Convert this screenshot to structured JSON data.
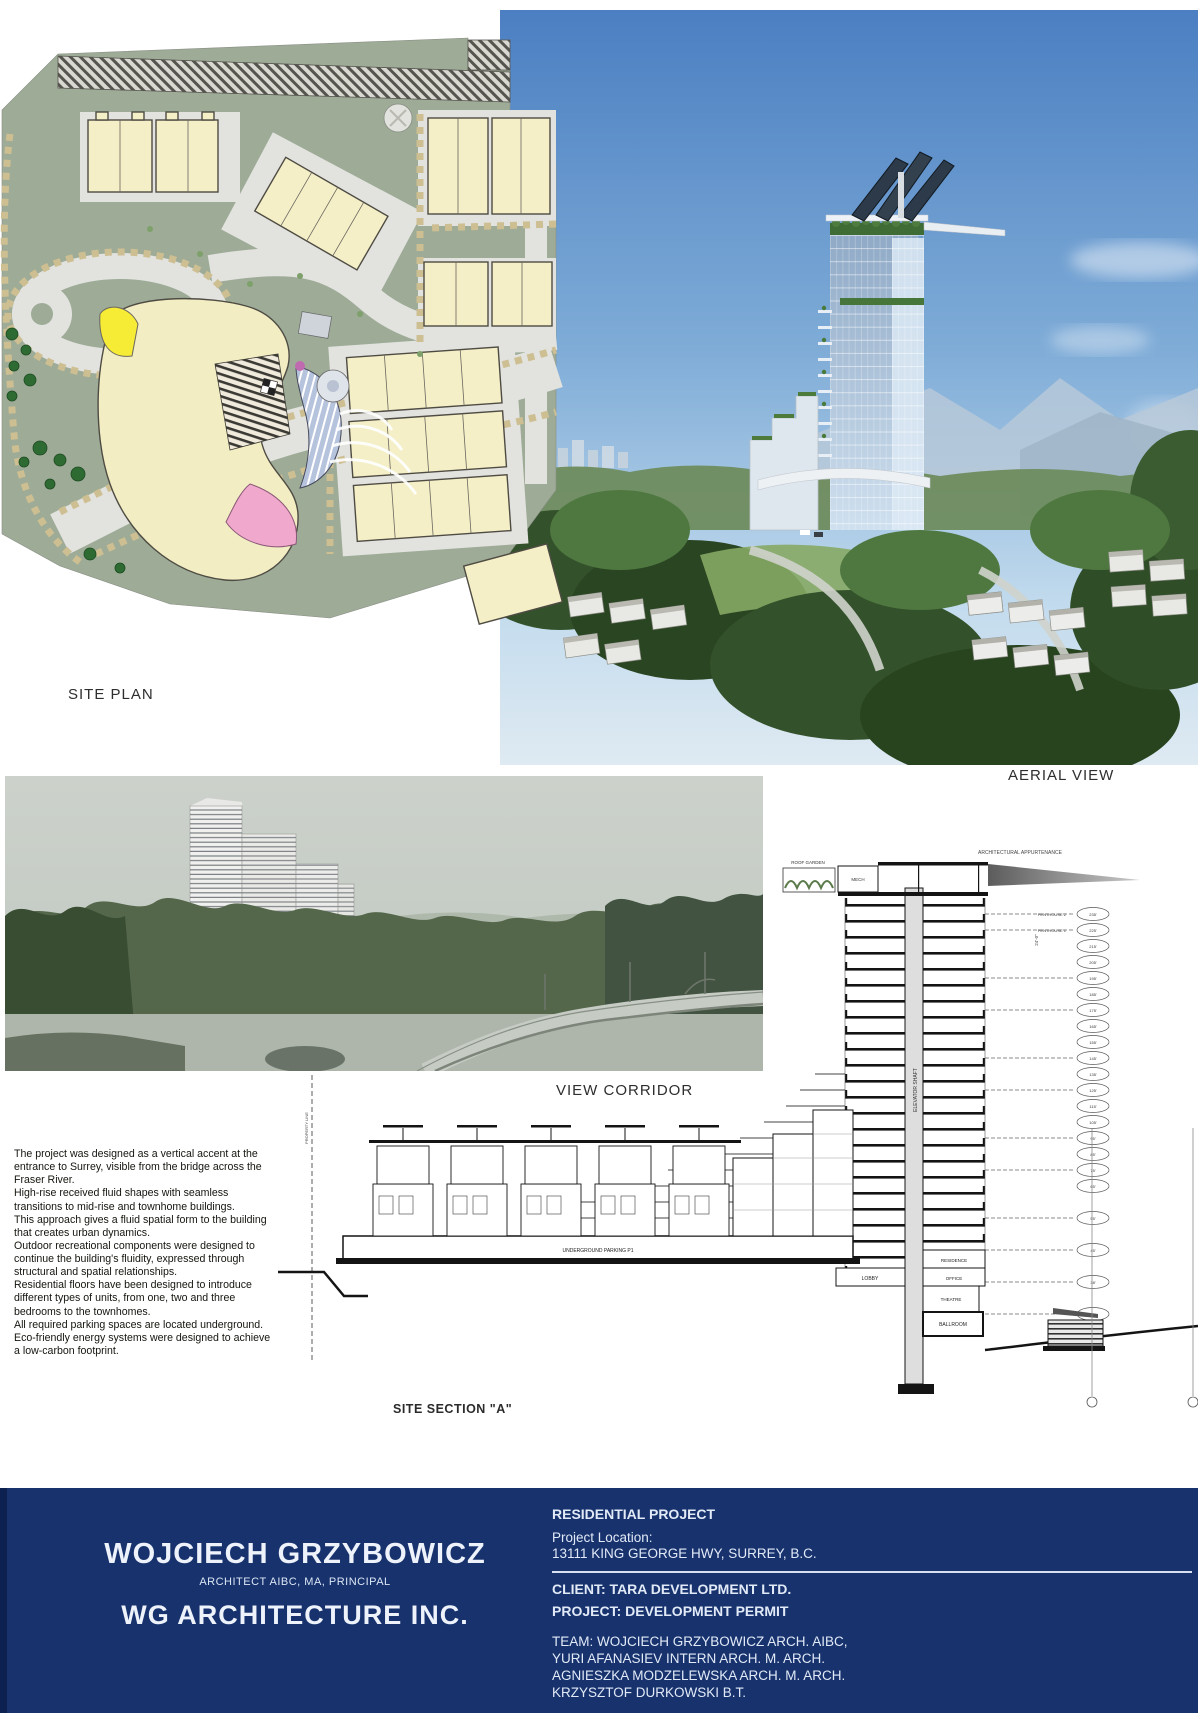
{
  "panels": {
    "site_plan": {
      "label": "SITE PLAN"
    },
    "aerial": {
      "label": "AERIAL VIEW"
    },
    "view_corridor": {
      "label": "VIEW CORRIDOR"
    },
    "section": {
      "label": "SITE SECTION \"A\"",
      "annotations": {
        "architectural_appurtenance": "ARCHITECTURAL APPURTENANCE",
        "roof_garden": "ROOF GARDEN",
        "mech": "MECH",
        "penthouse_upper": "PENTHOUSE 2",
        "penthouse_lower": "PENTHOUSE 1",
        "elevator_shaft": "ELEVATOR SHAFT",
        "lobby": "LOBBY",
        "residence": "RESIDENCE",
        "office": "OFFICE",
        "theatre": "THEATRE",
        "ballroom": "BALLROOM",
        "underground_parking": "UNDERGROUND PARKING P1",
        "green_buffer": "GREEN BUFFER",
        "property_line": "PROPERTY LINE",
        "dim_height": "24'-0\""
      },
      "elevations": [
        "235'",
        "225'",
        "215'",
        "205'",
        "195'",
        "185'",
        "175'",
        "165'",
        "155'",
        "145'",
        "135'",
        "125'",
        "115'",
        "105'",
        "95'",
        "85'",
        "75'",
        "65'",
        "55'",
        "45'",
        "38'",
        "28'"
      ]
    }
  },
  "description": {
    "paragraphs": [
      "The project was designed as a vertical accent at the entrance to Surrey, visible from the bridge across the Fraser River.",
      "High-rise received fluid shapes with seamless transitions to mid-rise and townhome buildings.",
      "This approach gives a fluid spatial form to the building that creates urban dynamics.",
      "Outdoor recreational components were designed to continue the building's fluidity, expressed through structural and spatial relationships.",
      "Residential floors have been designed to introduce different types of units, from one, two and three bedrooms to the townhomes.",
      "All required parking spaces are located underground.",
      "Eco-friendly energy systems were designed to achieve a low-carbon footprint."
    ]
  },
  "footer": {
    "architect_name": "WOJCIECH GRZYBOWICZ",
    "architect_title": "ARCHITECT AIBC, MA, PRINCIPAL",
    "firm": "WG ARCHITECTURE INC.",
    "project_type": "RESIDENTIAL PROJECT",
    "location_label": "Project Location:",
    "location": "13111 KING GEORGE HWY, SURREY,  B.C.",
    "client": "CLIENT:  TARA DEVELOPMENT LTD.",
    "project": "PROJECT:  DEVELOPMENT PERMIT",
    "team_line1": "TEAM:  WOJCIECH GRZYBOWICZ ARCH. AIBC,",
    "team_line2": "YURI AFANASIEV INTERN ARCH. M. ARCH.",
    "team_line3": "AGNIESZKA  MODZELEWSKA ARCH. M. ARCH.",
    "team_line4": "KRZYSZTOF DURKOWSKI B.T.",
    "colors": {
      "footer_bg": "#17326d",
      "footer_edge": "#0c2150"
    }
  }
}
